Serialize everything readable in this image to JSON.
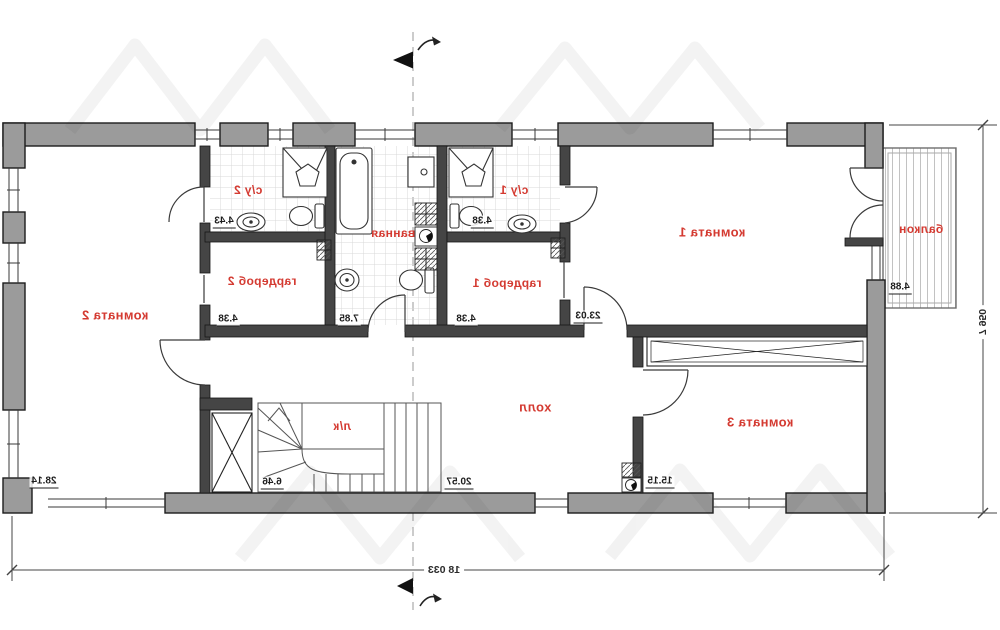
{
  "plan": {
    "rooms": [
      {
        "id": "komnata2",
        "label": "комната 2",
        "area": "28.14"
      },
      {
        "id": "su2",
        "label": "с/у 2",
        "area": "4.43"
      },
      {
        "id": "garderob2",
        "label": "гардероб 2",
        "area": "4.38"
      },
      {
        "id": "vannaya",
        "label": "ванная",
        "area": "7.85"
      },
      {
        "id": "su1",
        "label": "с/у 1",
        "area": "4.38"
      },
      {
        "id": "garderob1",
        "label": "гардероб 1",
        "area": "4.38"
      },
      {
        "id": "komnata1",
        "label": "комната 1",
        "area": "23.03"
      },
      {
        "id": "balkon",
        "label": "балкон",
        "area": "4.88"
      },
      {
        "id": "kholl",
        "label": "холл",
        "area": "20.57"
      },
      {
        "id": "komnata3",
        "label": "комната 3",
        "area": "15.15"
      },
      {
        "id": "lk",
        "label": "л/к",
        "area": "6.46"
      }
    ],
    "dimensions": {
      "bottom": "18 033",
      "right": "7 950"
    },
    "colors": {
      "wall_outer": "#9b9b9b",
      "wall_inner": "#454545",
      "label_red": "#d43a31",
      "area_text": "#1d1d1d"
    }
  }
}
